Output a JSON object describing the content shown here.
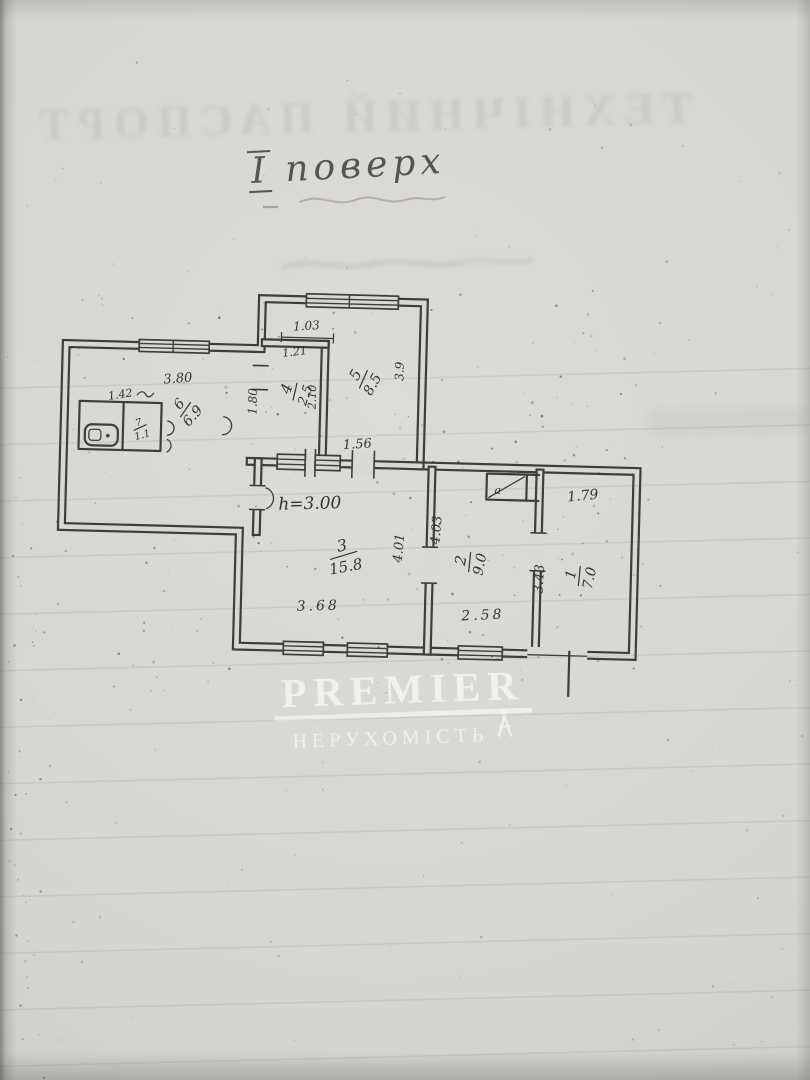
{
  "document": {
    "floor_label": {
      "numeral": "І",
      "word": "поверх"
    },
    "bleedthrough_title": "ТЕХНІЧНИЙ ПАСПОРТ"
  },
  "watermark": {
    "brand": "PREMIER",
    "subtitle": "НЕРУХОМІСТЬ",
    "icon": "person-figure-icon",
    "color": "#f7f6f2"
  },
  "plan": {
    "height_note": "h=3.00",
    "closet_label": "а",
    "rooms": [
      {
        "number": "1",
        "area": "7.0"
      },
      {
        "number": "2",
        "area": "9.0"
      },
      {
        "number": "3",
        "area": "15.8"
      },
      {
        "number": "4",
        "area": "2.5"
      },
      {
        "number": "5",
        "area": "8.5"
      },
      {
        "number": "6",
        "area": "6.9"
      },
      {
        "number": "7",
        "area": "1.1"
      }
    ],
    "dimensions": {
      "passage_top": "1.03",
      "room4_width": "1.21",
      "room4_depth": "2.10",
      "room5_depth": "3.9",
      "room5_bottom": "1.56",
      "room6_top": "3.80",
      "room6_side": "1.42",
      "corridor": "1.80",
      "room3_bottom": "3.68",
      "room3_depth": "4.01",
      "room2_depth": "4.03",
      "room2_bottom": "2.58",
      "room1_top": "1.79",
      "room1_depth": "3.43"
    }
  }
}
